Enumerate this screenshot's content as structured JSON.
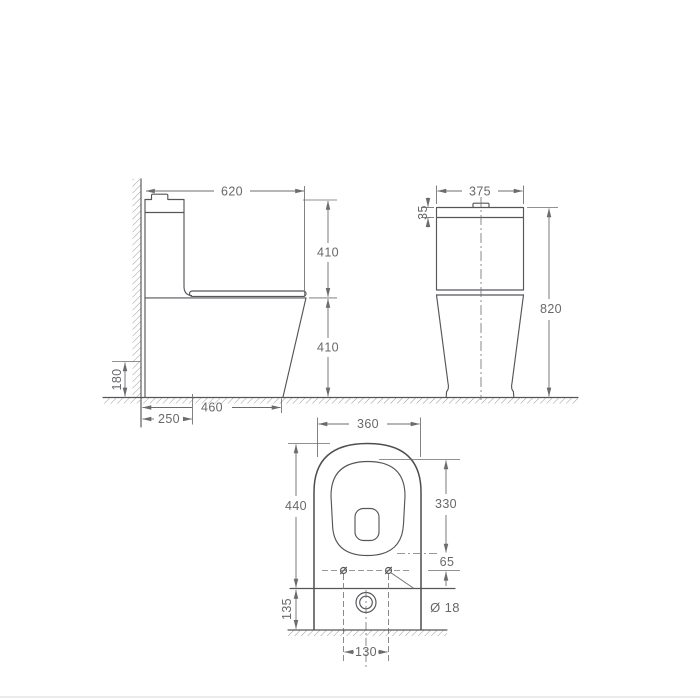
{
  "drawing": {
    "title": "Back-to-wall toilet suite dimension drawing",
    "units": "mm",
    "side_view": {
      "label": "side-elevation",
      "overall_depth": "620",
      "upper_height": "410",
      "lower_height": "410",
      "inlet_height": "180",
      "front_setout": "460",
      "outlet_setout": "250"
    },
    "front_view": {
      "label": "front-elevation",
      "overall_width": "375",
      "lid_thickness": "35",
      "overall_height": "820"
    },
    "plan_view": {
      "label": "plan",
      "bowl_width": "360",
      "bowl_depth": "440",
      "seat_opening_depth": "330",
      "seat_to_holes": "65",
      "rear_depth": "135",
      "hole_spacing": "130",
      "hole_diameter": "Ø 18"
    }
  }
}
